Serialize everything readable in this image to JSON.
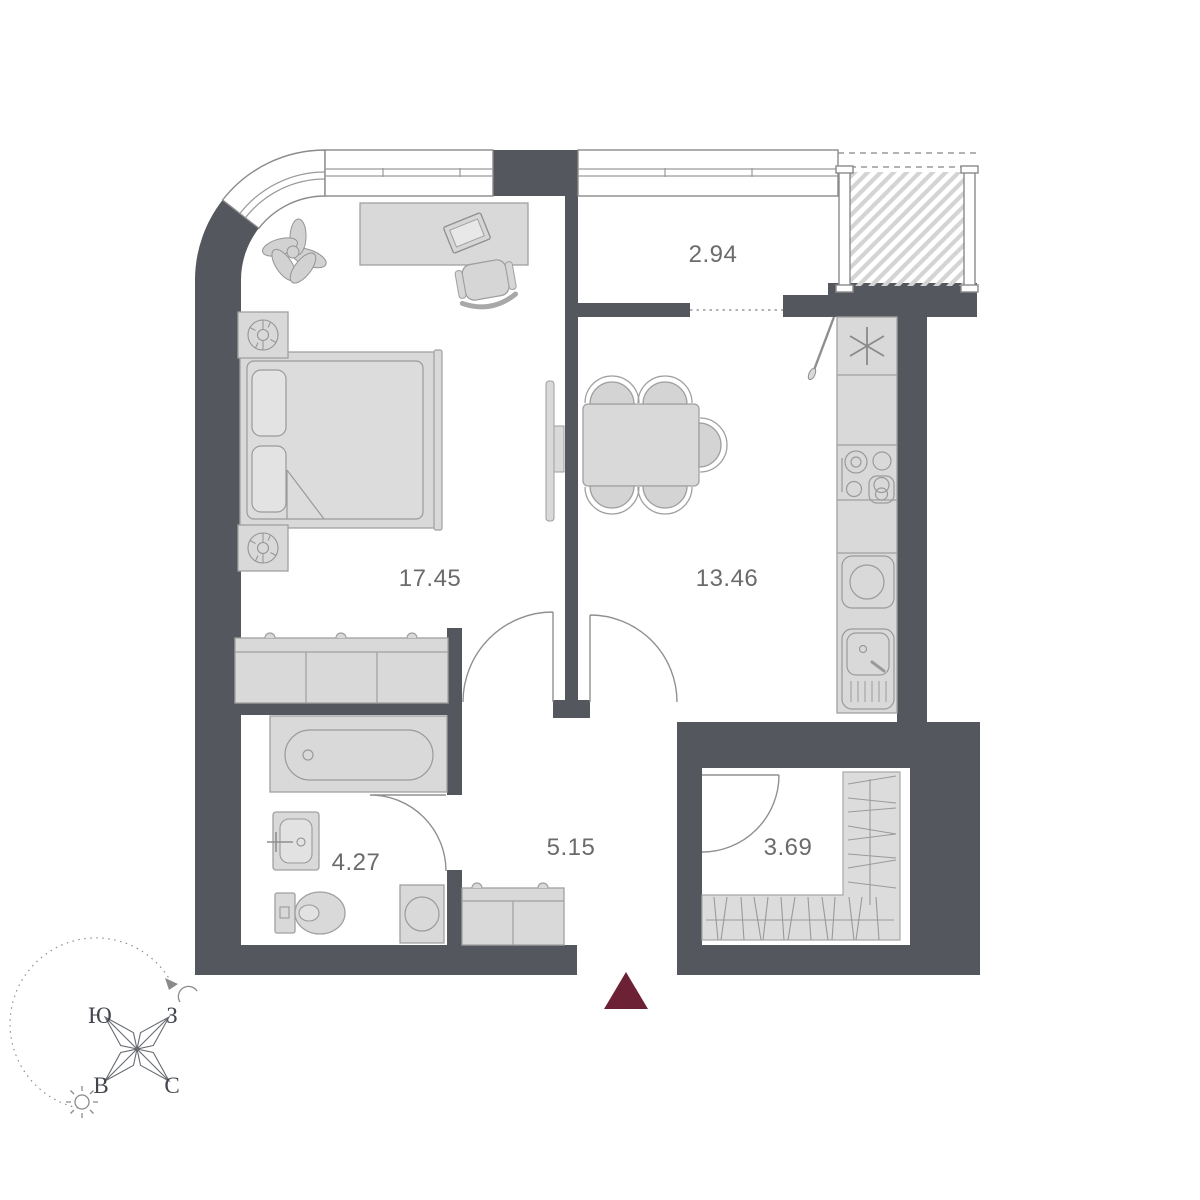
{
  "title": "Apartment floor plan",
  "floor_plan": {
    "rooms": [
      {
        "name": "bedroom",
        "area_label": "17.45"
      },
      {
        "name": "kitchen-living",
        "area_label": "13.46"
      },
      {
        "name": "balcony",
        "area_label": "2.94"
      },
      {
        "name": "bathroom",
        "area_label": "4.27"
      },
      {
        "name": "hallway",
        "area_label": "5.15"
      },
      {
        "name": "wardrobe",
        "area_label": "3.69"
      }
    ],
    "compass": {
      "south_label": "Ю",
      "west_label": "З",
      "east_label": "В",
      "north_label": "С"
    },
    "icons": {
      "entrance_marker": "triangle-up",
      "freezer": "asterisk",
      "orientation_day": "sun",
      "orientation_night": "crescent-moon"
    },
    "colors": {
      "wall": "#54575d",
      "entrance_marker": "#6d2135",
      "furniture_fill": "#d9d9d9",
      "label_text": "#6b6b6b"
    }
  }
}
